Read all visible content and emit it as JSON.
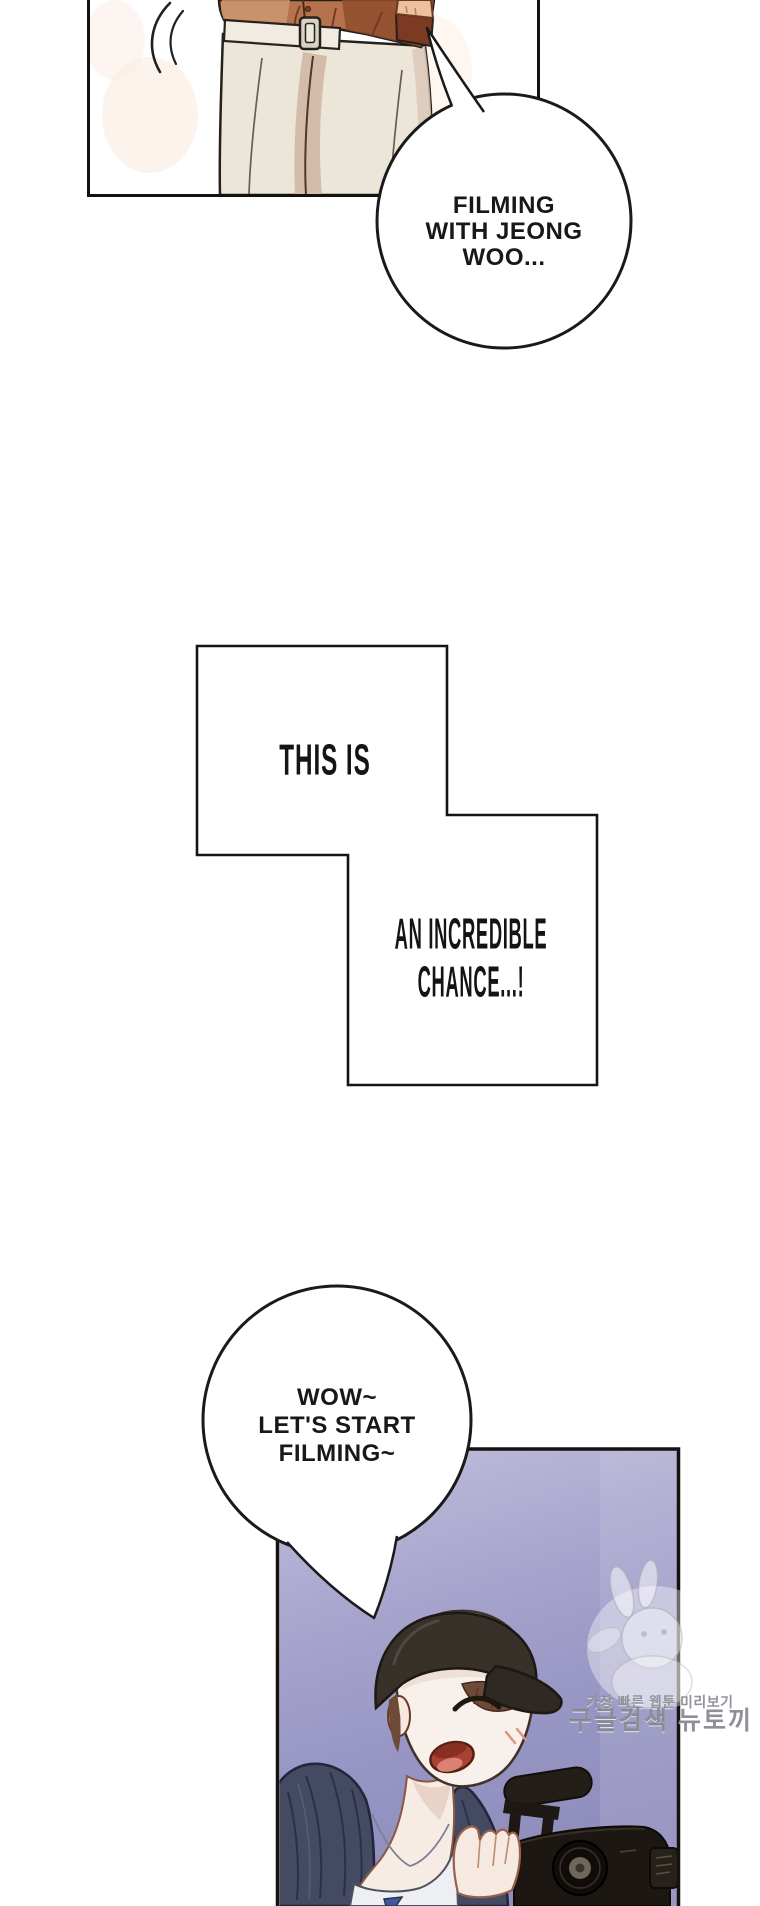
{
  "speech": {
    "bubble1": {
      "line1": "FILMING",
      "line2": "WITH JEONG",
      "line3": "WOO..."
    },
    "bubble2": {
      "line1": "WOW~",
      "line2": "LET'S START",
      "line3": "FILMING~"
    }
  },
  "captions": {
    "box1_line1": "THIS IS",
    "box2_line1": "AN INCREDIBLE",
    "box2_line2": "CHANCE...!"
  },
  "watermark": {
    "line1": "가장 빠른 웹툰 미리보기",
    "line2": "구글검색 뉴토끼"
  },
  "palette": {
    "ink": "#1a1a1a",
    "page_bg": "#ffffff",
    "panel2_purple_light": "#c2c0db",
    "panel2_purple": "#a7a5cd",
    "panel2_purple_deep": "#8f8dbc",
    "shirt_tan": "#b5724c",
    "pants_cream": "#ebe6d7",
    "belt_cream": "#f1ece1",
    "hoodie_navy": "#444a62",
    "skin": "#f7efe9",
    "cap_dark": "#37312a",
    "hair_brown": "#6e4a38",
    "camera_black": "#1c1712",
    "watermark_gray": "#8a8a94"
  }
}
